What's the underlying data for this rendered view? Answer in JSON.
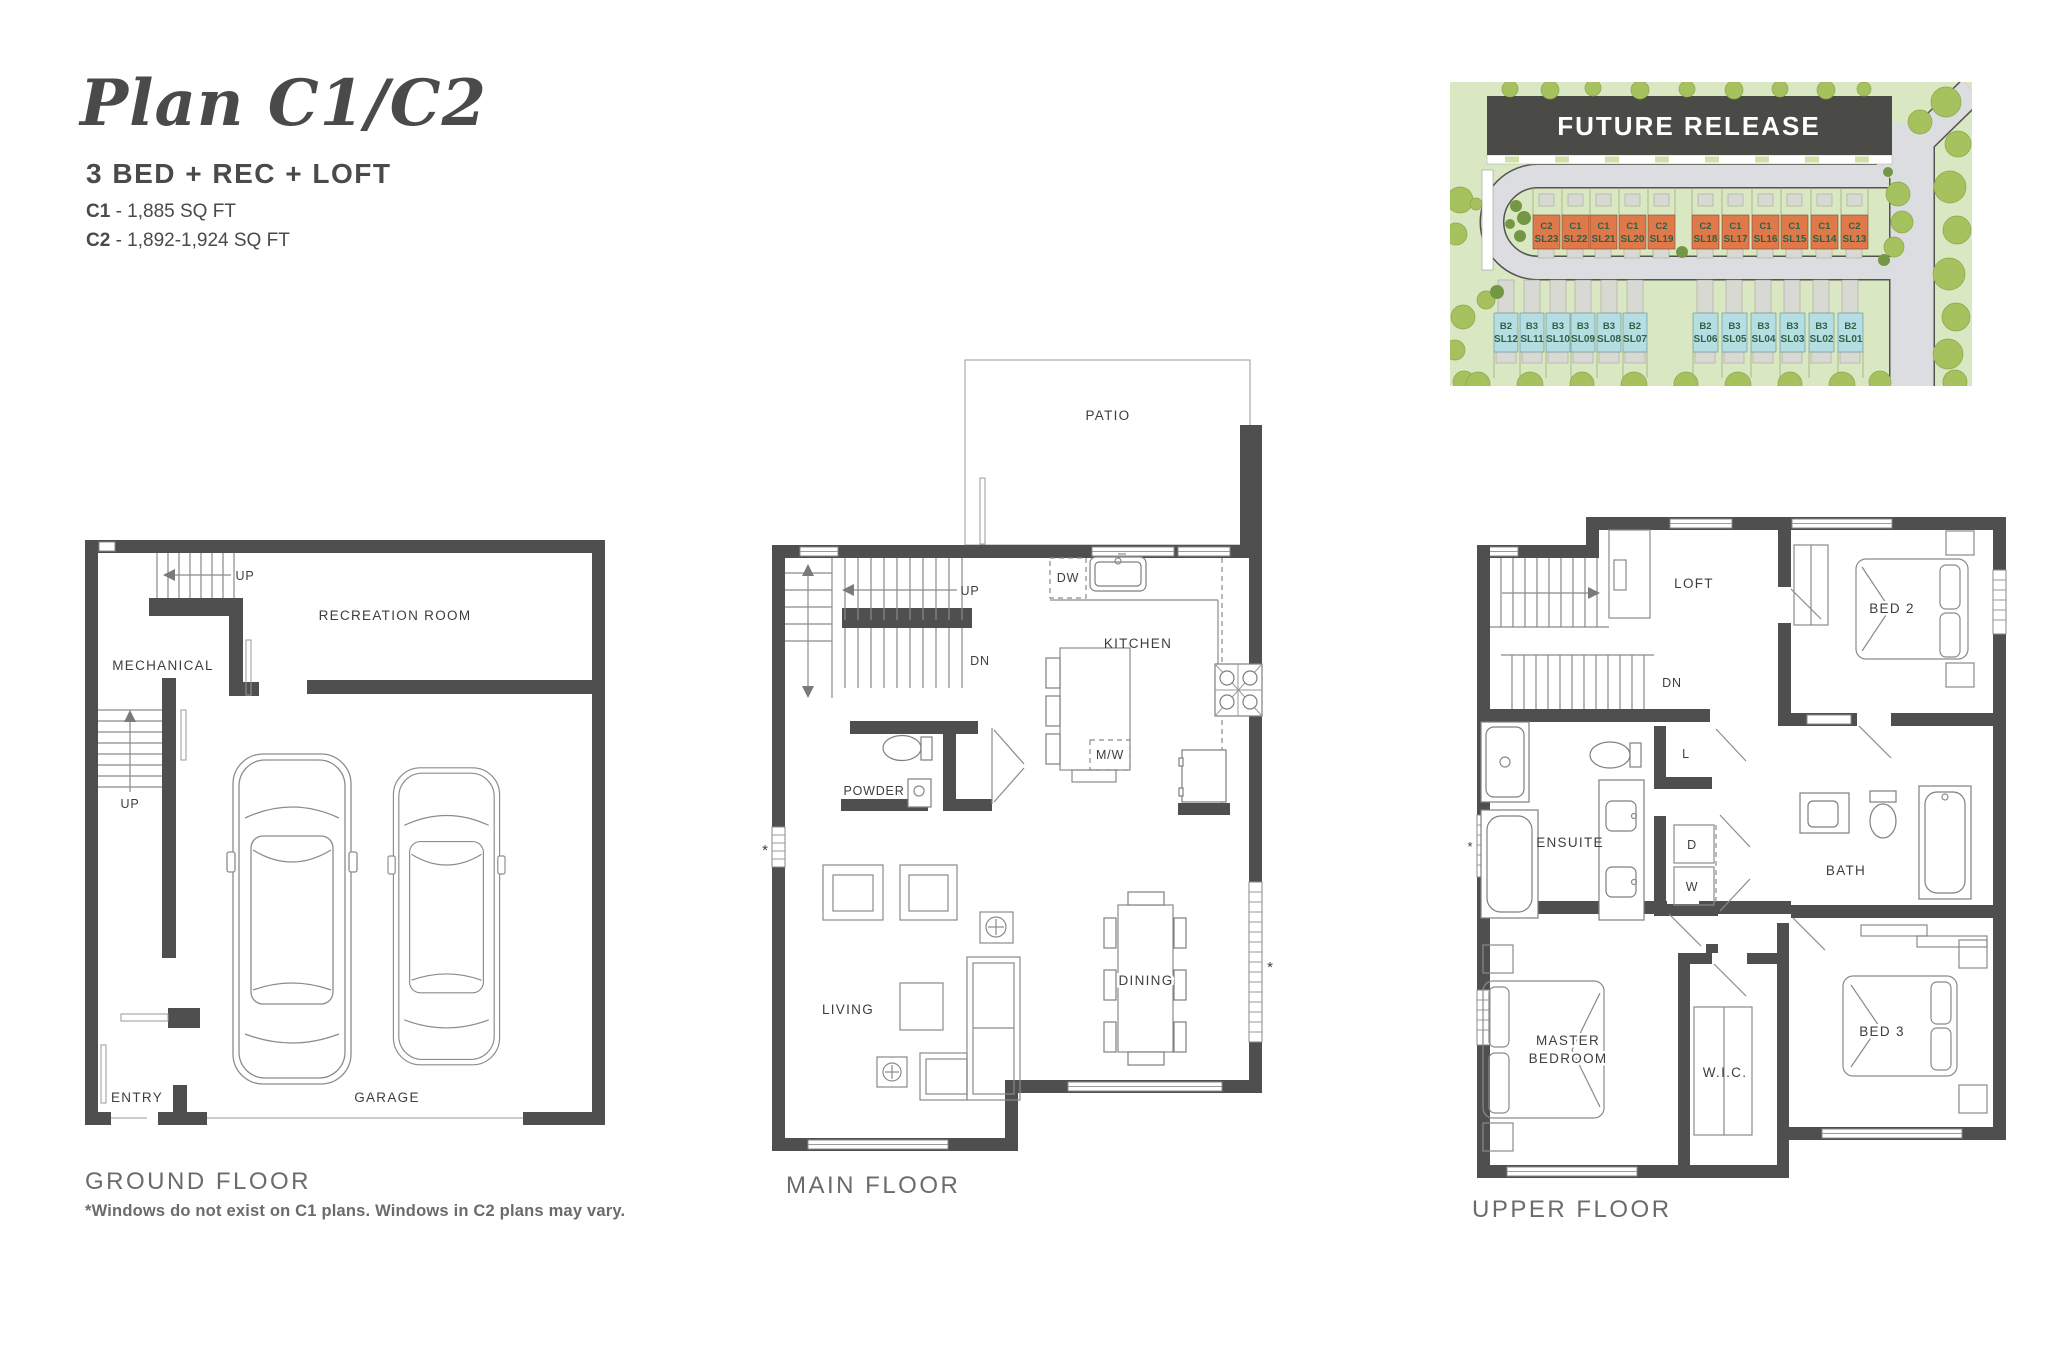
{
  "header": {
    "title": "Plan C1/C2",
    "subtitle": "3 BED + REC + LOFT",
    "specs": [
      {
        "code": "C1",
        "area": "- 1,885 SQ FT"
      },
      {
        "code": "C2",
        "area": "- 1,892-1,924 SQ FT"
      }
    ]
  },
  "site_map": {
    "banner": "FUTURE RELEASE",
    "colors": {
      "c_lot": "#e0794a",
      "b_lot": "#b4dee2",
      "banner": "#4a4a46"
    },
    "c_lots": [
      {
        "type": "C2",
        "sl": "SL23"
      },
      {
        "type": "C1",
        "sl": "SL22"
      },
      {
        "type": "C1",
        "sl": "SL21"
      },
      {
        "type": "C1",
        "sl": "SL20"
      },
      {
        "type": "C2",
        "sl": "SL19"
      },
      {
        "type": "C2",
        "sl": "SL18"
      },
      {
        "type": "C1",
        "sl": "SL17"
      },
      {
        "type": "C1",
        "sl": "SL16"
      },
      {
        "type": "C1",
        "sl": "SL15"
      },
      {
        "type": "C1",
        "sl": "SL14"
      },
      {
        "type": "C2",
        "sl": "SL13"
      }
    ],
    "b_lots": [
      {
        "type": "B2",
        "sl": "SL12"
      },
      {
        "type": "B3",
        "sl": "SL11"
      },
      {
        "type": "B3",
        "sl": "SL10"
      },
      {
        "type": "B3",
        "sl": "SL09"
      },
      {
        "type": "B3",
        "sl": "SL08"
      },
      {
        "type": "B2",
        "sl": "SL07"
      },
      {
        "type": "B2",
        "sl": "SL06"
      },
      {
        "type": "B3",
        "sl": "SL05"
      },
      {
        "type": "B3",
        "sl": "SL04"
      },
      {
        "type": "B3",
        "sl": "SL03"
      },
      {
        "type": "B3",
        "sl": "SL02"
      },
      {
        "type": "B2",
        "sl": "SL01"
      }
    ]
  },
  "floors": {
    "ground": {
      "name": "GROUND FLOOR",
      "note": "*Windows do not exist on C1 plans. Windows in C2 plans may vary.",
      "labels": {
        "up_top": "UP",
        "recreation": "RECREATION ROOM",
        "mechanical": "MECHANICAL",
        "up_left": "UP",
        "entry": "ENTRY",
        "garage": "GARAGE"
      }
    },
    "main": {
      "name": "MAIN FLOOR",
      "labels": {
        "patio": "PATIO",
        "up": "UP",
        "dn": "DN",
        "dw": "DW",
        "kitchen": "KITCHEN",
        "mw": "M/W",
        "powder": "POWDER",
        "living": "LIVING",
        "dining": "DINING",
        "window_note_mark": "*"
      }
    },
    "upper": {
      "name": "UPPER FLOOR",
      "labels": {
        "loft": "LOFT",
        "dn": "DN",
        "bed2": "BED 2",
        "linen": "L",
        "ensuite": "ENSUITE",
        "dryer": "D",
        "washer": "W",
        "bath": "BATH",
        "master_line1": "MASTER",
        "master_line2": "BEDROOM",
        "wic": "W.I.C.",
        "bed3": "BED 3",
        "window_note_mark": "*"
      }
    }
  }
}
